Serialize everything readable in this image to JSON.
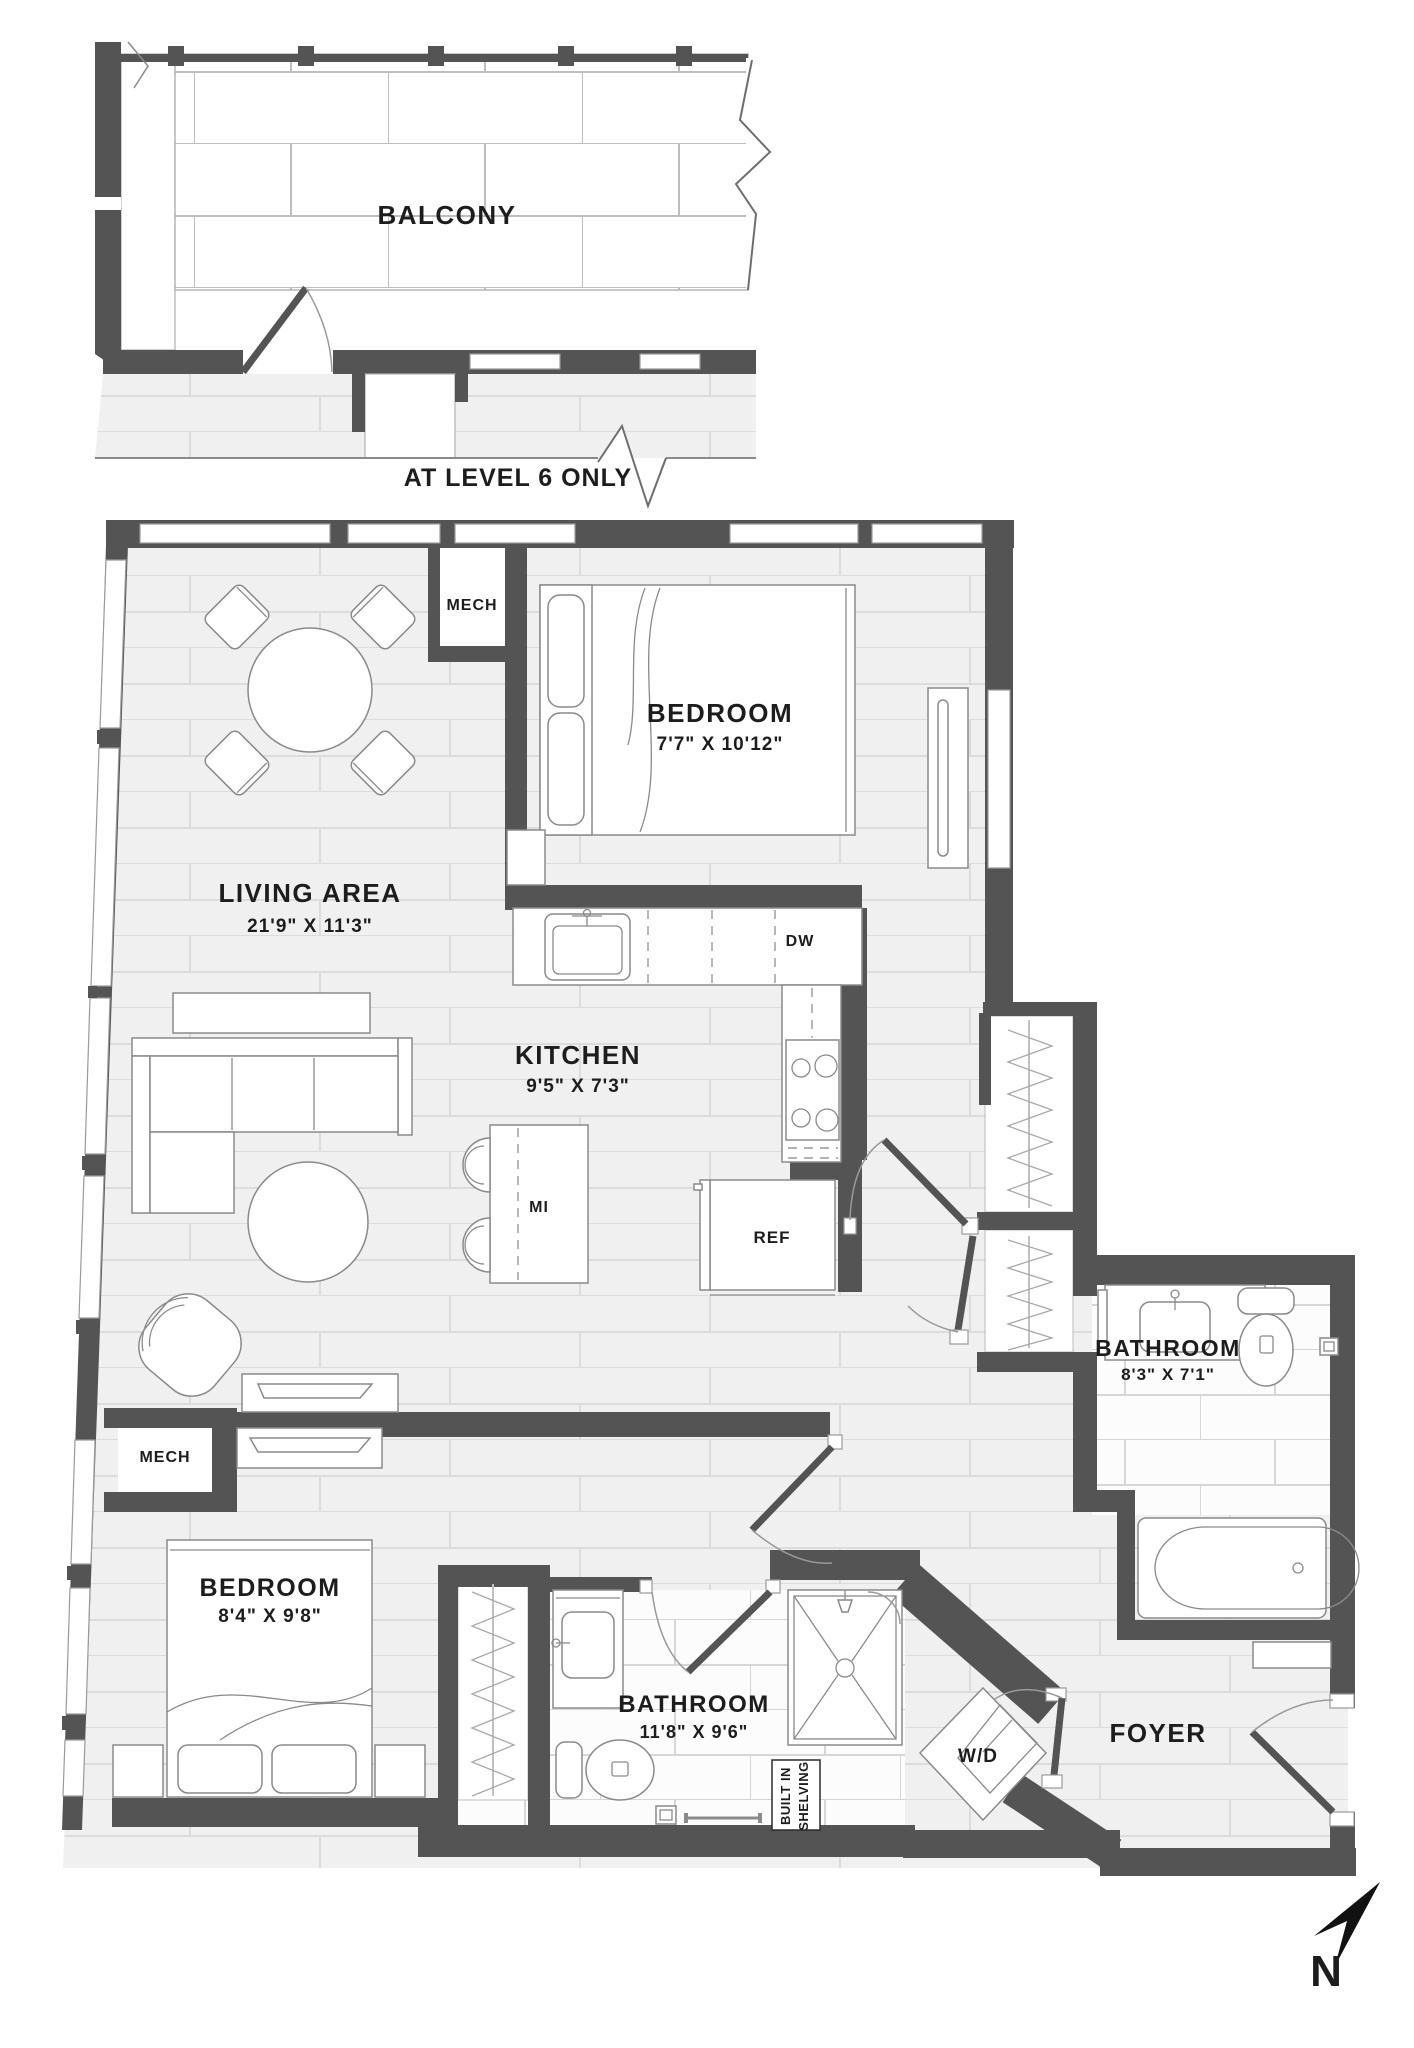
{
  "plan": {
    "balcony": {
      "label": "BALCONY",
      "note": "AT LEVEL 6 ONLY"
    },
    "rooms": {
      "living": {
        "name": "LIVING AREA",
        "dims": "21'9\" X 11'3\""
      },
      "bedroom1": {
        "name": "BEDROOM",
        "dims": "7'7\" X 10'12\""
      },
      "kitchen": {
        "name": "KITCHEN",
        "dims": "9'5\" X 7'3\""
      },
      "bathroom1": {
        "name": "BATHROOM",
        "dims": "8'3\" X 7'1\""
      },
      "bedroom2": {
        "name": "BEDROOM",
        "dims": "8'4\" X 9'8\""
      },
      "bathroom2": {
        "name": "BATHROOM",
        "dims": "11'8\" X 9'6\""
      },
      "foyer": {
        "name": "FOYER"
      },
      "mech1": {
        "label": "MECH"
      },
      "mech2": {
        "label": "MECH"
      }
    },
    "fixtures": {
      "dishwasher": "DW",
      "island": "MI",
      "fridge": "REF",
      "washer_dryer": "W/D",
      "built_in_line1": "BUILT IN",
      "built_in_line2": "SHELVING"
    },
    "compass": {
      "label": "N"
    },
    "colors": {
      "wall": "#545454",
      "floor": "#f0f0f0",
      "plank_line": "#dcdcdc",
      "tile_bg": "#fcfcfc",
      "tile_line": "#d6d6d6",
      "balcony_tile_line": "#bdbdbd",
      "text": "#1d1d1d",
      "fixture_stroke": "#8a8a8a"
    }
  }
}
